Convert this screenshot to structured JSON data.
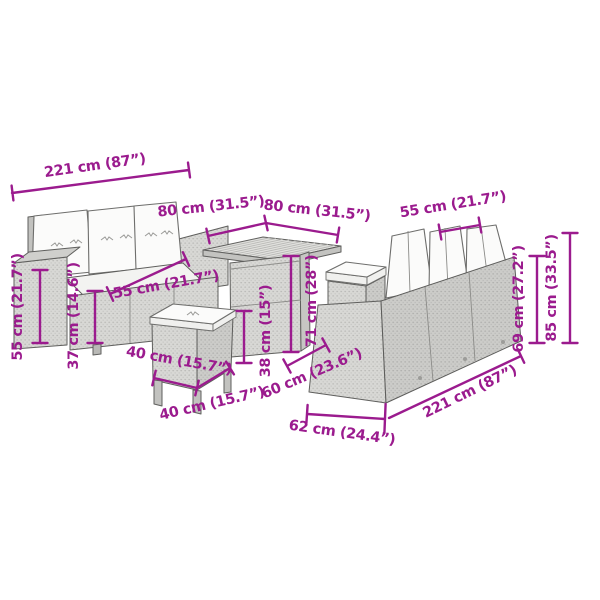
{
  "diagram": {
    "type": "product-dimension-diagram",
    "subject": "poly rattan garden lounge set: two 3-seat sofas, square table, two stools",
    "background": "#ffffff",
    "accent_color": "#9b1b8e",
    "colors": {
      "rattan_gray": "#d8d8d5",
      "rattan_dark": "#b8b8b5",
      "cushion_white": "#fbfbfa",
      "outline": "#5f5f5d"
    }
  },
  "dimensions": {
    "sofa_left_width": "221 cm (87”)",
    "table_top_width": "80 cm (31.5”)",
    "table_top_depth": "80 cm (31.5”)",
    "back_cushion_width": "55 cm (21.7”)",
    "backrest_height": "69 cm (27.2”)",
    "total_height": "85 cm (33.5”)",
    "armrest_height": "55 cm (21.7”)",
    "seat_height": "37 cm (14.6”)",
    "seat_cushion_width": "55 cm (21.7”)",
    "stool_width": "40 cm (15.7”)",
    "stool_depth": "40 cm (15.7”)",
    "stool_height": "38 cm (15”)",
    "table_height": "71 cm (28”)",
    "table_base_depth": "60 cm (23.6”)",
    "sofa_depth": "62 cm (24.4”)",
    "sofa_right_width": "221 cm (87”)"
  }
}
